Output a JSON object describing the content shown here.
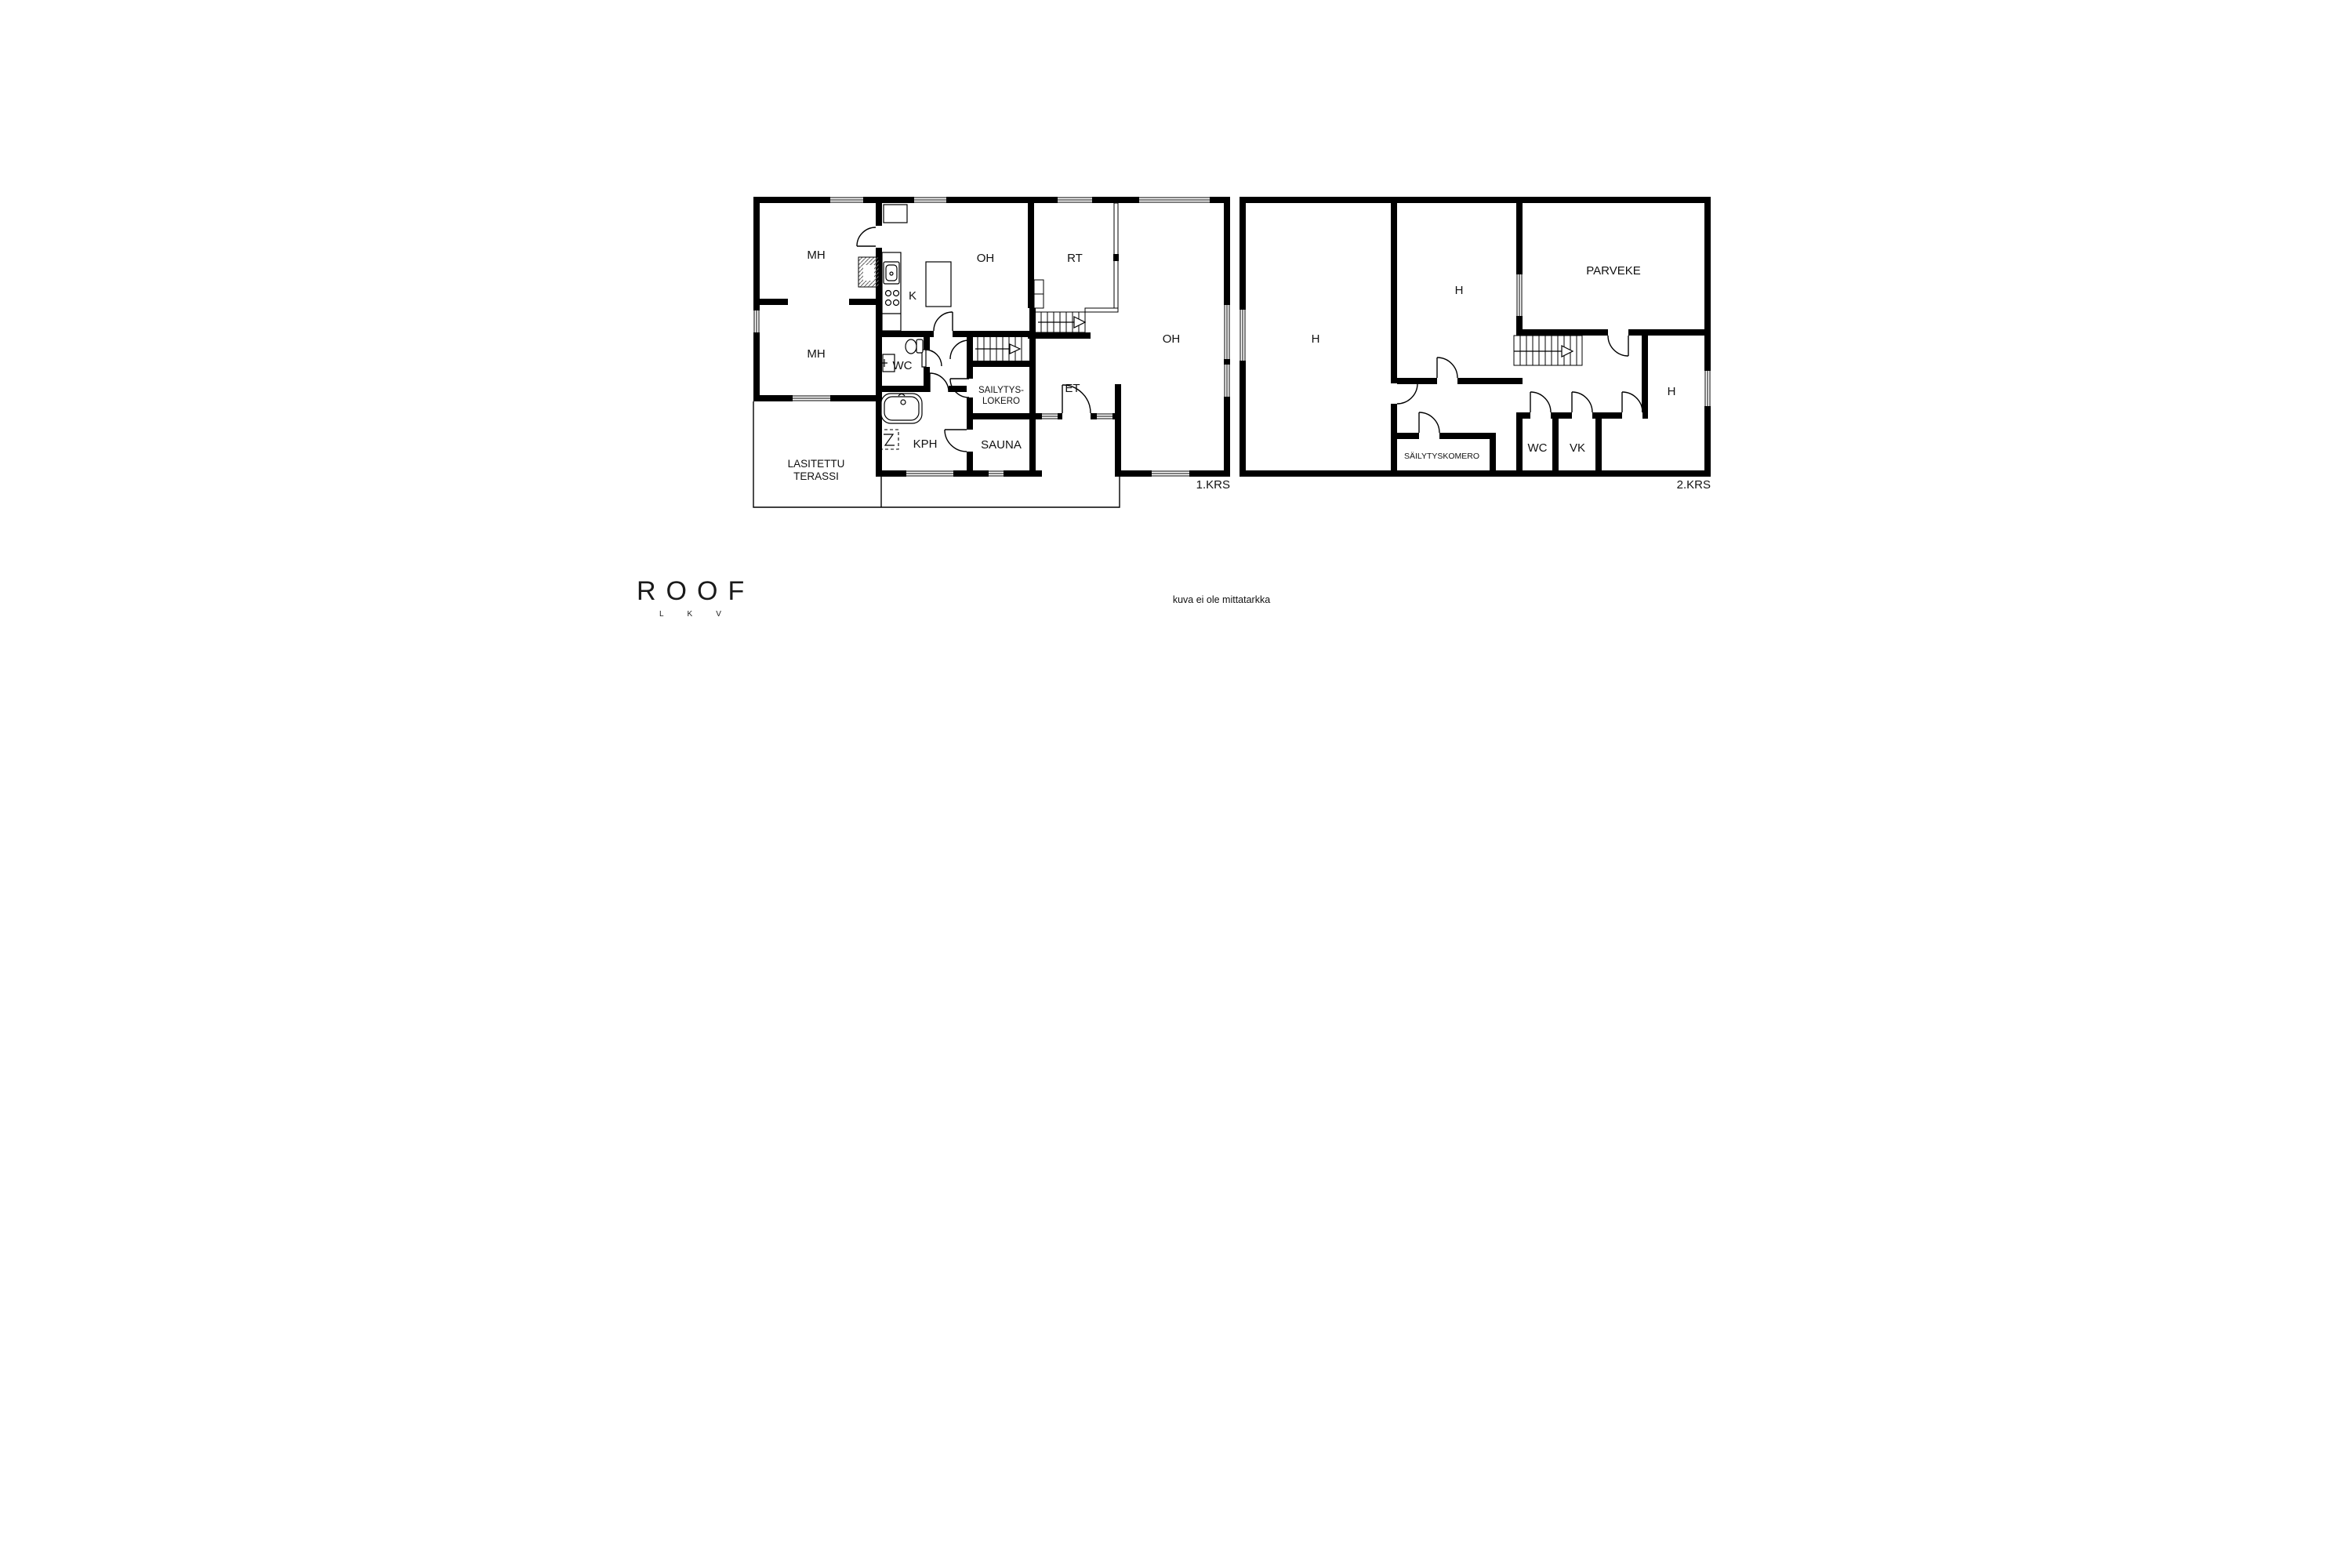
{
  "floor1": {
    "label": "1.KRS",
    "rooms": {
      "mh_top": "MH",
      "mh_bottom": "MH",
      "kitchen": "K",
      "oh_upper": "OH",
      "rt": "RT",
      "oh_main": "OH",
      "wc": "WC",
      "storage_line1": "SAILYTYS-",
      "storage_line2": "LOKERO",
      "et": "ET",
      "kph": "KPH",
      "sauna": "SAUNA",
      "terrace_line1": "LASITETTU",
      "terrace_line2": "TERASSI"
    }
  },
  "floor2": {
    "label": "2.KRS",
    "rooms": {
      "h_left": "H",
      "h_middle": "H",
      "balcony": "PARVEKE",
      "storage": "SÄILYTYSKOMERO",
      "wc": "WC",
      "vk": "VK",
      "h_right": "H"
    }
  },
  "branding": {
    "logo": "ROOF",
    "logo_sub": "LKV"
  },
  "disclaimer": "kuva ei ole mittatarkka",
  "colors": {
    "wall": "#000000",
    "background": "#ffffff",
    "text": "#1a1a1a"
  }
}
